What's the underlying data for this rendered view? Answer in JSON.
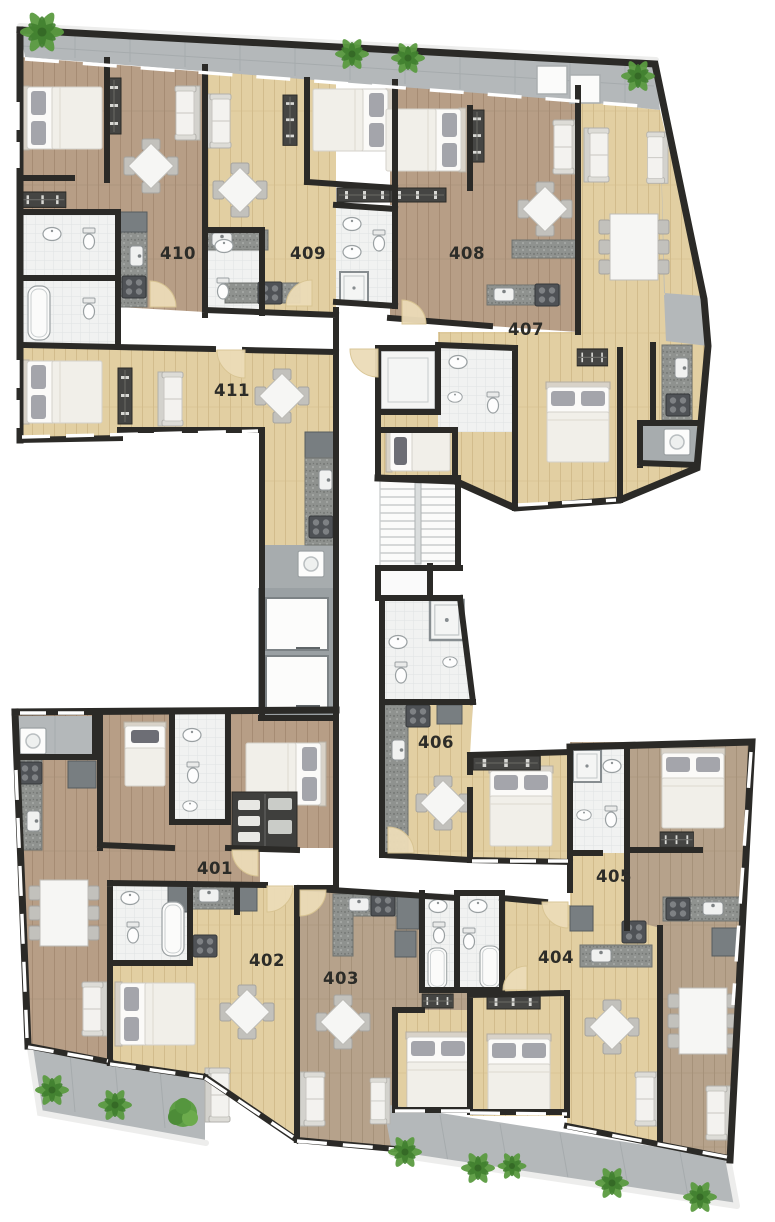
{
  "page": {
    "type": "architectural floor plan, top-down rendered view",
    "background": "#ffffff",
    "units_visible": 11
  },
  "units": [
    {
      "number": "401"
    },
    {
      "number": "402"
    },
    {
      "number": "403"
    },
    {
      "number": "404"
    },
    {
      "number": "405"
    },
    {
      "number": "406"
    },
    {
      "number": "407"
    },
    {
      "number": "408"
    },
    {
      "number": "409"
    },
    {
      "number": "410"
    },
    {
      "number": "411"
    }
  ],
  "palette": {
    "wall": "#2b2a27",
    "wood-dark": "#b79e86",
    "wood-dark-line": "#a68c74",
    "wood-light": "#e2cfa2",
    "wood-light-line": "#d2bc8c",
    "wood-mid": "#b6a28b",
    "wood-mid-line": "#a6927a",
    "balcony": "#b4b8ba",
    "balcony-line": "#a6abad",
    "bathroom": "#f1f2f1",
    "tile-line": "#e0e3e2",
    "counter": "#8f928f",
    "cabinet": "#787e81",
    "utility": "#a7acae",
    "door": "#ecdcb8",
    "plant": "#5b9b41",
    "furniture": "#f6f6f4"
  },
  "icons": {
    "double-bed": "white mattress, two grey pillows",
    "single-bed": "white mattress, one dark pillow",
    "sofa": "grey-backed settee",
    "dining-table-4": "square table rotated 45deg with 4 chairs",
    "dining-table-6": "rectangular table with 6 chairs",
    "stove": "dark hob with 4 burners",
    "kitchen-sink": "rounded basin with tap",
    "toilet": "tank + bowl",
    "oval-sink": "oval basin",
    "bathtub": "rounded rectangle tub",
    "shower": "square tray",
    "washer": "white machine with round door",
    "wardrobe": "dark strip with hangers",
    "stairs": "treads with centre rail",
    "elevator": "two white cabins in grey shaft",
    "door-swing": "tan quarter-circle",
    "plant": "green palm leaves",
    "bush": "round green shrub"
  }
}
